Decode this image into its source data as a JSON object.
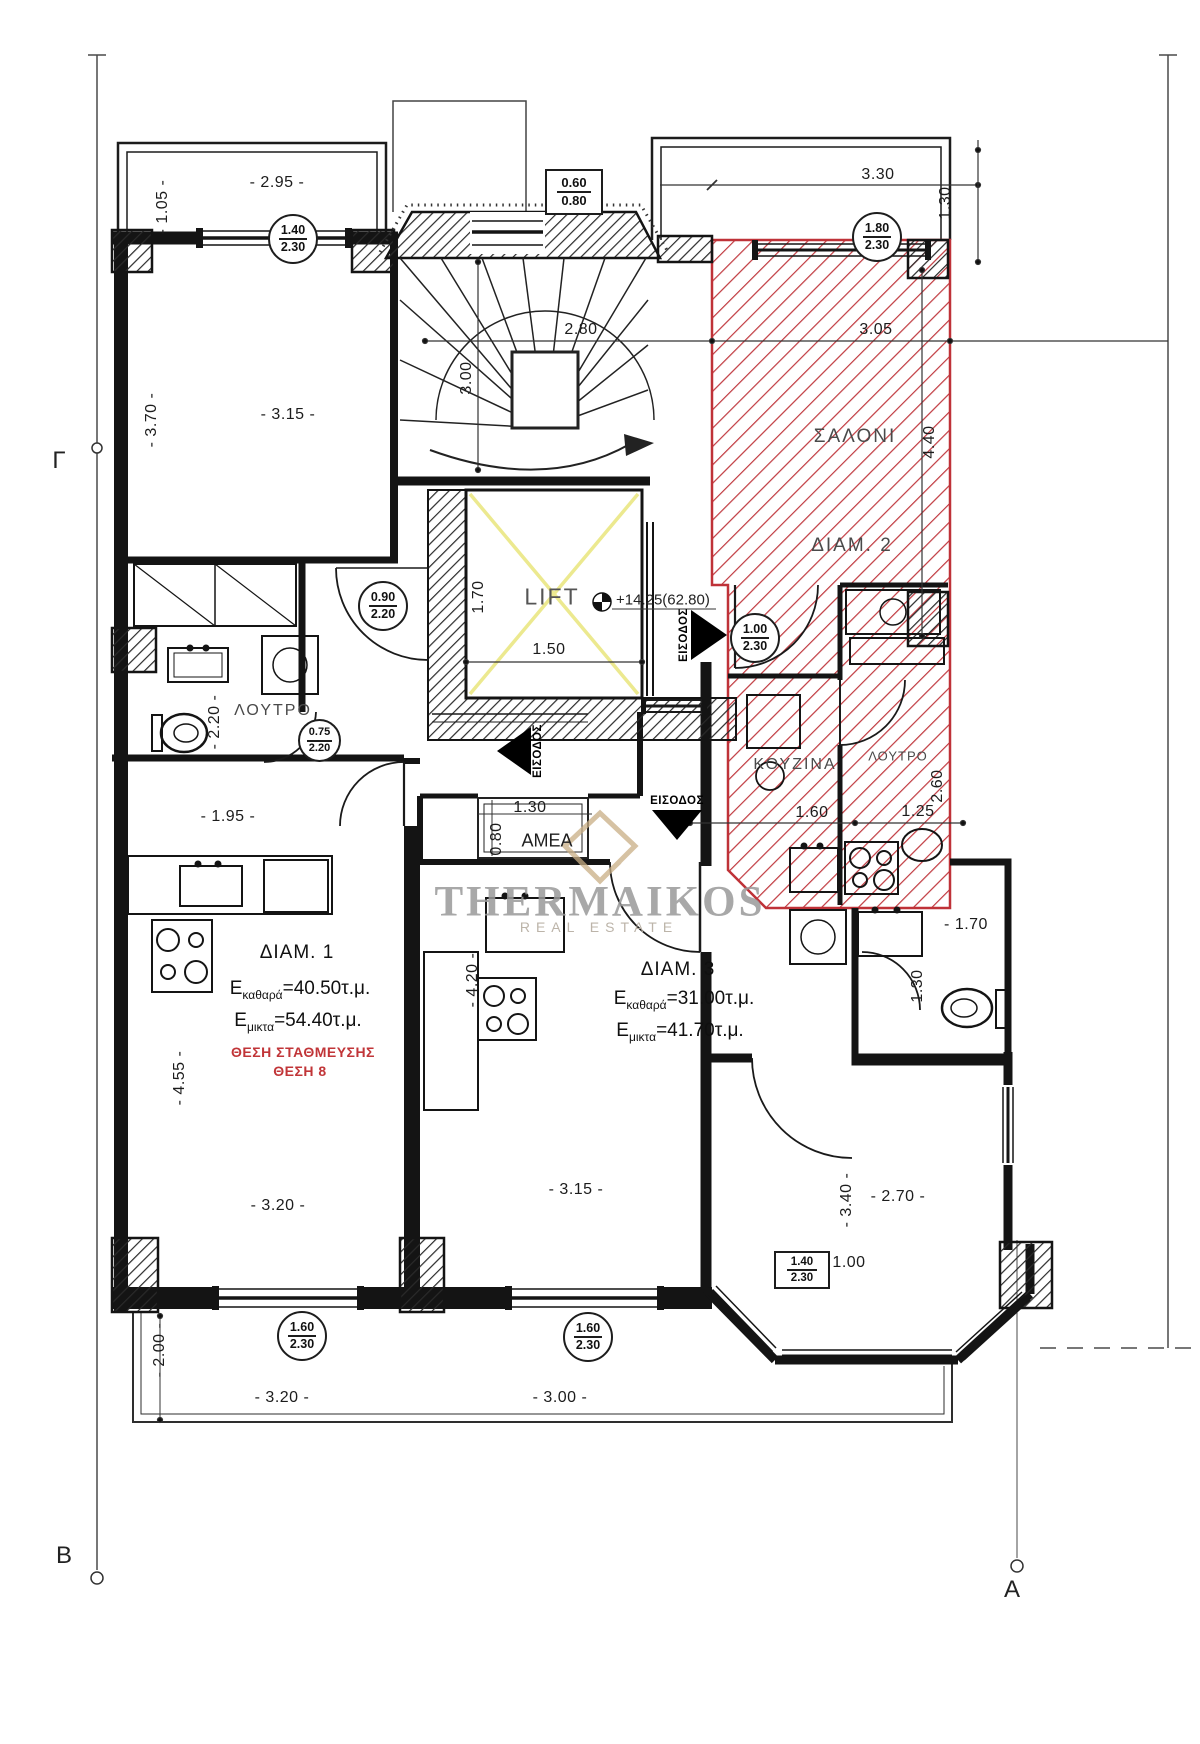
{
  "drawing": {
    "colors": {
      "hatch_red": "#c0393f",
      "outline_red": "#bf3238",
      "parking_text_red": "#c13538",
      "line_black": "#141414",
      "lift_x_yellow": "#ece98f",
      "watermark_gray": "#9a9a9a",
      "watermark_tan": "#c9ae85"
    },
    "grid_markers": {
      "left": "Γ",
      "bottom_left": "Β",
      "bottom_right": "Α"
    },
    "level_marker": "+14.25(62.80)",
    "watermark": {
      "name": "THERMAIKOS",
      "tagline": "REAL ESTATE"
    },
    "labels": {
      "living_room": "ΣΑΛΟΝΙ",
      "kitchen": "ΚΟΥΖΙΝΑ",
      "bathroom": "ΛΟΥΤΡΟ",
      "lift": "LIFT",
      "entrance": "ΕΙΣΟΔΟΣ",
      "accessible_ramp": "AMEA"
    },
    "apartments": {
      "apt1": {
        "title": "ΔΙΑΜ. 1",
        "e": "E",
        "net_sub": "καθαρά",
        "net_val": "=40.50τ.μ.",
        "gross_sub": "μικτα",
        "gross_val": "=54.40τ.μ.",
        "parking_line1": "ΘΕΣΗ ΣΤΑΘΜΕΥΣΗΣ",
        "parking_line2": "ΘΕΣΗ 8"
      },
      "apt2": {
        "title": "ΔΙΑΜ. 2"
      },
      "apt3": {
        "title": "ΔΙΑΜ. 3",
        "e": "E",
        "net_sub": "καθαρά",
        "net_val": "=31.00τ.μ.",
        "gross_sub": "μικτα",
        "gross_val": "=41.70τ.μ."
      }
    },
    "window_tags": {
      "t1": {
        "w": "1.40",
        "h": "2.30"
      },
      "t2": {
        "w": "1.80",
        "h": "2.30"
      },
      "t3": {
        "w": "0.90",
        "h": "2.20"
      },
      "t4": {
        "w": "0.75",
        "h": "2.20"
      },
      "t5": {
        "w": "1.00",
        "h": "2.30"
      },
      "t6": {
        "w": "1.60",
        "h": "2.30"
      },
      "t7": {
        "w": "1.60",
        "h": "2.30"
      },
      "t8": {
        "w": "0.60",
        "h": "0.80"
      },
      "t9": {
        "w": "1.40",
        "h": "2.30"
      }
    },
    "dims": [
      "- 2.95 -",
      "- 1.05 -",
      "- 3.15 -",
      "- 3.70 -",
      "2.80",
      "3.00",
      "3.30",
      "1.30",
      "3.05",
      "4.40",
      "- 2.20 -",
      "- 1.95 -",
      "1.70",
      "1.50",
      "1.30",
      "0.80",
      "1.60",
      "1.25",
      "2.60",
      "- 1.70",
      "1.30",
      "- 4.55 -",
      "- 3.20 -",
      "- 3.15 -",
      "- 4.20 -",
      "- 3.40 -",
      "- 2.70 -",
      "- 2.00 -",
      "- 3.20 -",
      "- 3.00 -",
      "1.00"
    ]
  }
}
